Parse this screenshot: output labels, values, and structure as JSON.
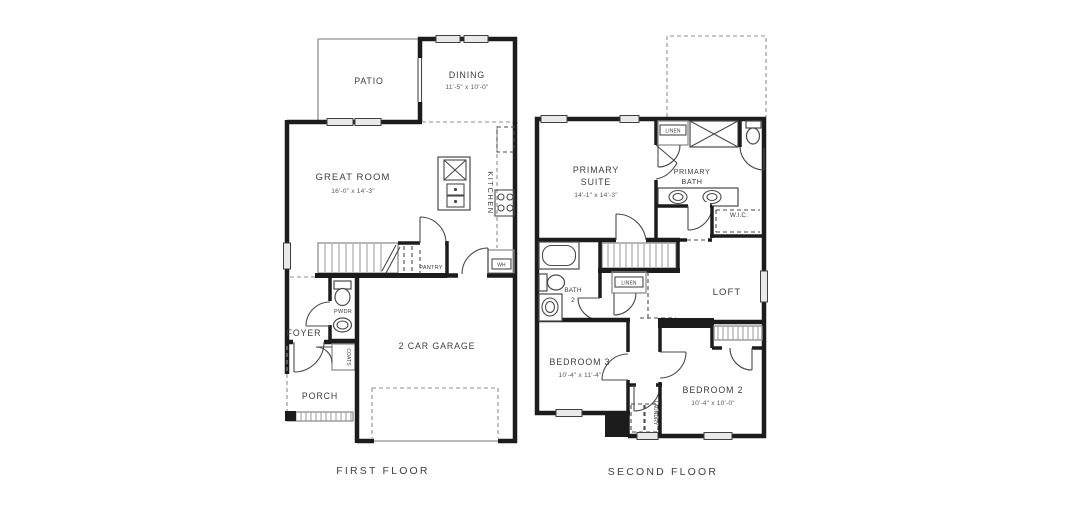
{
  "palette": {
    "wall": "#1c1c1c",
    "thin_line": "#8f8f8f",
    "window_fill": "#e9e9e9",
    "label_text": "#3d3d3d",
    "background": "#ffffff"
  },
  "floors": {
    "first": {
      "label": "FIRST FLOOR",
      "rooms": {
        "patio": {
          "name": "PATIO"
        },
        "dining": {
          "name": "DINING",
          "dims": "11'-5\" x 10'-0\""
        },
        "great_room": {
          "name": "GREAT ROOM",
          "dims": "16'-0\" x 14'-3\""
        },
        "kitchen": {
          "name": "KITCHEN"
        },
        "pantry": {
          "name": "PANTRY"
        },
        "water_heater": {
          "name": "WH"
        },
        "powder": {
          "name": "PWDR"
        },
        "foyer": {
          "name": "FOYER"
        },
        "coats": {
          "name": "COATS"
        },
        "porch": {
          "name": "PORCH"
        },
        "garage": {
          "name": "2 CAR GARAGE"
        }
      }
    },
    "second": {
      "label": "SECOND FLOOR",
      "rooms": {
        "primary_suite": {
          "line1": "PRIMARY",
          "line2": "SUITE",
          "dims": "14'-1\" x 14'-3\""
        },
        "primary_bath": {
          "line1": "PRIMARY",
          "line2": "BATH"
        },
        "linen_upper": {
          "name": "LINEN"
        },
        "wic": {
          "name": "W.I.C."
        },
        "bath2": {
          "line1": "BATH",
          "line2": "2"
        },
        "linen_hall": {
          "name": "LINEN"
        },
        "loft": {
          "name": "LOFT"
        },
        "bedroom3": {
          "name": "BEDROOM 3",
          "dims": "10'-4\" x 11'-4\""
        },
        "laundry": {
          "name": "LAUNDRY"
        },
        "bedroom2": {
          "name": "BEDROOM 2",
          "dims": "10'-4\" x 10'-0\""
        }
      }
    }
  }
}
